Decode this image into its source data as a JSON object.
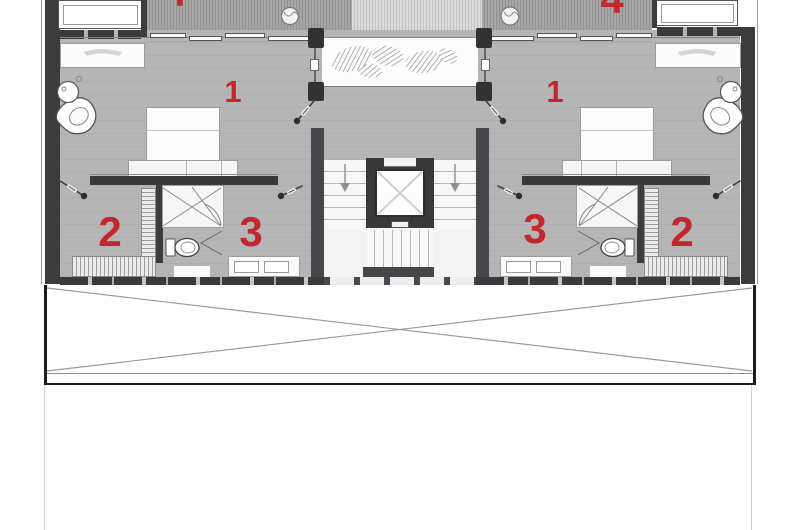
{
  "plan": {
    "type": "architectural-floor-plan",
    "room_labels": [
      {
        "id": "bedroom-left",
        "label": "1"
      },
      {
        "id": "bedroom-right",
        "label": "1"
      },
      {
        "id": "lounge-left",
        "label": "2"
      },
      {
        "id": "lounge-right",
        "label": "2"
      },
      {
        "id": "bathroom-zone-left",
        "label": "3"
      },
      {
        "id": "bathroom-zone-right",
        "label": "3"
      },
      {
        "id": "deck-top-right-partial",
        "label": "4"
      },
      {
        "id": "deck-top-left-partial",
        "label": "4"
      }
    ],
    "colors": {
      "label_red": "#c2272d",
      "wall_dark": "#3b3c3e",
      "floor_gray": "#b3b3b4",
      "deck_gray": "#a6a6a7",
      "paper_white": "#ffffff"
    }
  }
}
